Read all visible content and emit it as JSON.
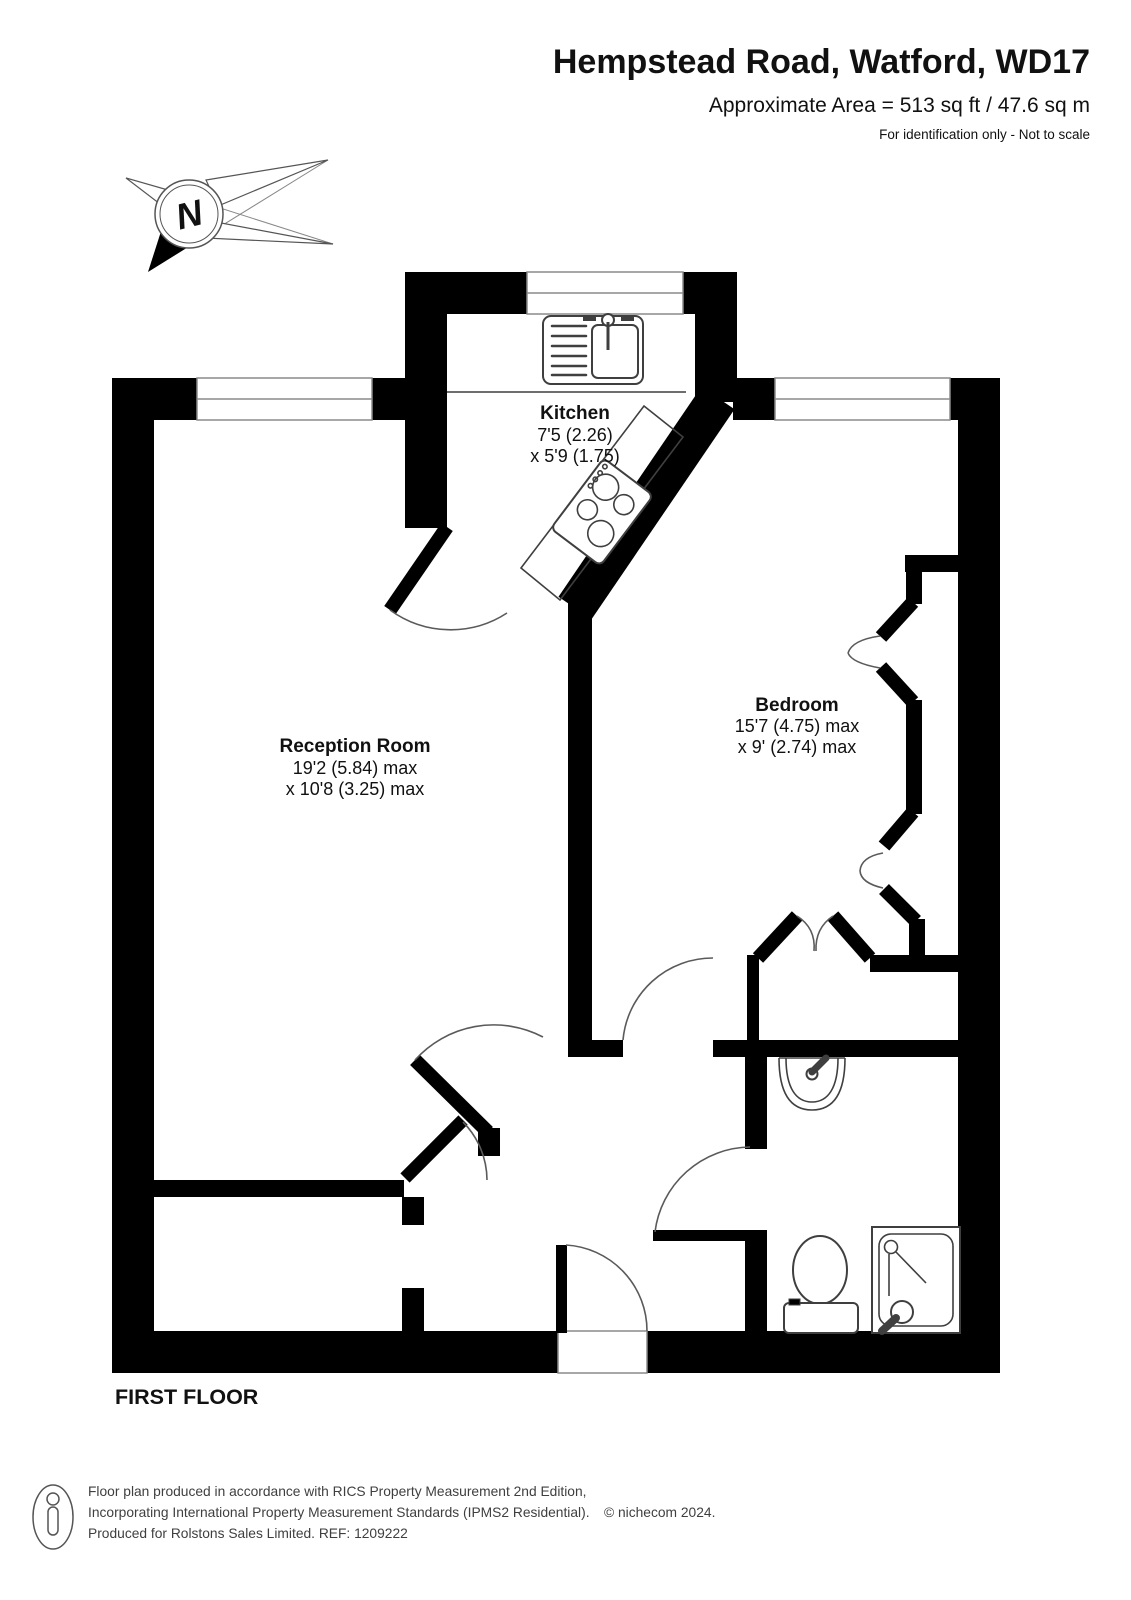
{
  "header": {
    "title": "Hempstead Road, Watford, WD17",
    "area": "Approximate Area = 513 sq ft / 47.6 sq m",
    "note": "For identification only - Not to scale"
  },
  "compass": {
    "north_label": "N"
  },
  "rooms": [
    {
      "name": "Kitchen",
      "dim_line1": "7'5 (2.26)",
      "dim_line2": "x 5'9 (1.75)"
    },
    {
      "name": "Reception Room",
      "dim_line1": "19'2 (5.84) max",
      "dim_line2": "x 10'8 (3.25) max"
    },
    {
      "name": "Bedroom",
      "dim_line1": "15'7 (4.75) max",
      "dim_line2": "x 9' (2.74) max"
    }
  ],
  "floor_label": "FIRST FLOOR",
  "footer": {
    "line1": "Floor plan produced in accordance with RICS Property Measurement 2nd Edition,",
    "line2": "Incorporating International Property Measurement Standards (IPMS2 Residential).",
    "copyright": "© nichecom 2024.",
    "line3": "Produced for Rolstons Sales Limited.   REF: 1209222"
  },
  "colors": {
    "wall": "#000000",
    "fixture_line": "#3f3f3f",
    "text": "#111111",
    "footer_text": "#3f3f3f",
    "window_frame": "#8a8a8a"
  }
}
